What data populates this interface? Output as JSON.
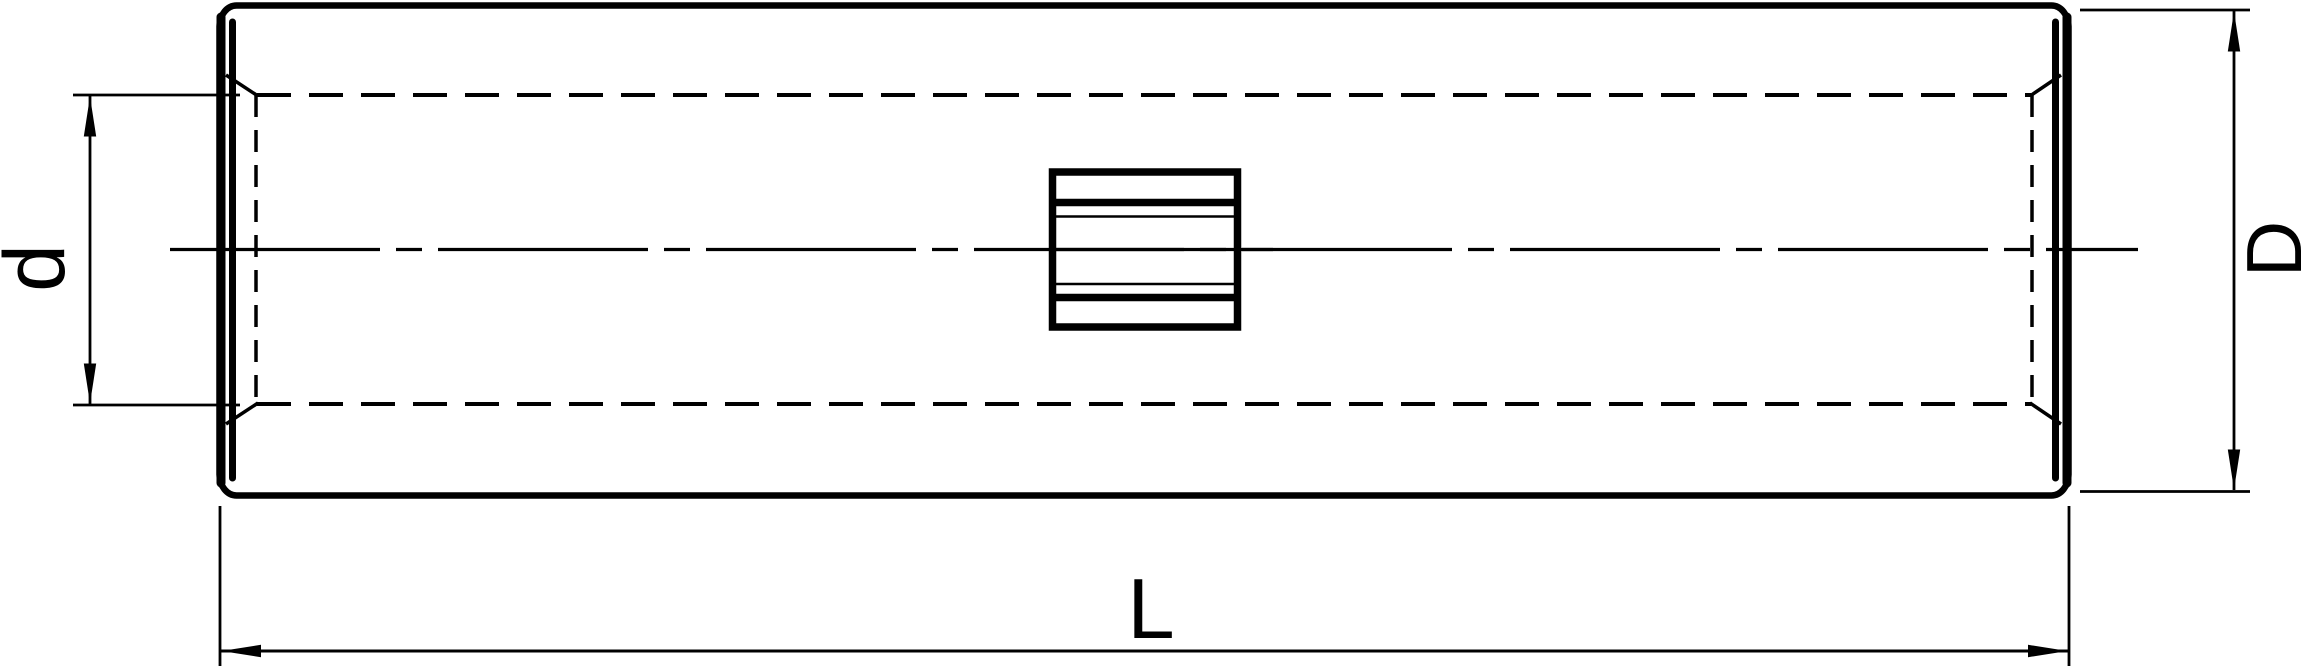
{
  "drawing": {
    "background_color": "#ffffff",
    "line_color": "#000000",
    "object": "cylindrical butt splice connector, side view with hidden bore lines and center rib",
    "dimensions": [
      {
        "id": "inner-diameter",
        "label": "d",
        "position": "left",
        "orientation": "vertical",
        "measures": "bore (inner) diameter"
      },
      {
        "id": "outer-diameter",
        "label": "D",
        "position": "right",
        "orientation": "vertical",
        "measures": "outer diameter"
      },
      {
        "id": "length",
        "label": "L",
        "position": "bottom",
        "orientation": "horizontal",
        "measures": "overall length"
      }
    ]
  }
}
